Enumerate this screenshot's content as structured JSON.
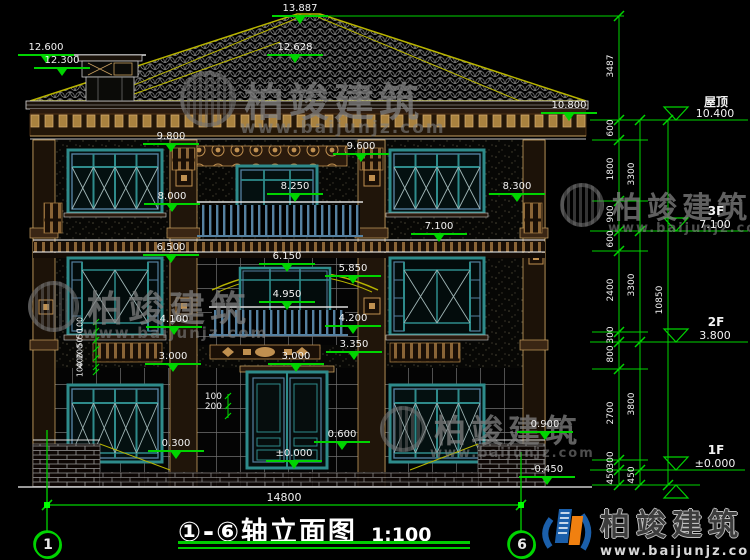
{
  "drawing": {
    "title": "①-⑥轴立面图",
    "scale": "1:100",
    "axis_left": "1",
    "axis_right": "6",
    "width_dim": "14800"
  },
  "elevation_markers": [
    {
      "label": "13.887",
      "x": 300,
      "y": 3
    },
    {
      "label": "12.600",
      "x": 46,
      "y": 42
    },
    {
      "label": "12.300",
      "x": 62,
      "y": 55
    },
    {
      "label": "12.628",
      "x": 295,
      "y": 42
    },
    {
      "label": "10.800",
      "x": 569,
      "y": 100
    },
    {
      "label": "9.800",
      "x": 171,
      "y": 131
    },
    {
      "label": "9.600",
      "x": 361,
      "y": 141
    },
    {
      "label": "8.250",
      "x": 295,
      "y": 181
    },
    {
      "label": "8.000",
      "x": 172,
      "y": 191
    },
    {
      "label": "8.300",
      "x": 517,
      "y": 181
    },
    {
      "label": "7.100",
      "x": 439,
      "y": 221
    },
    {
      "label": "6.500",
      "x": 171,
      "y": 242
    },
    {
      "label": "6.150",
      "x": 287,
      "y": 251
    },
    {
      "label": "5.850",
      "x": 353,
      "y": 263
    },
    {
      "label": "4.950",
      "x": 287,
      "y": 289
    },
    {
      "label": "4.200",
      "x": 353,
      "y": 313
    },
    {
      "label": "4.100",
      "x": 174,
      "y": 314
    },
    {
      "label": "3.350",
      "x": 354,
      "y": 339
    },
    {
      "label": "3.000",
      "x": 173,
      "y": 351
    },
    {
      "label": "3.000",
      "x": 296,
      "y": 351
    },
    {
      "label": "0.600",
      "x": 342,
      "y": 429
    },
    {
      "label": "±0.000",
      "x": 294,
      "y": 448
    },
    {
      "label": "0.900",
      "x": 545,
      "y": 419
    },
    {
      "label": "0.300",
      "x": 176,
      "y": 438
    },
    {
      "label": "-0.450",
      "x": 547,
      "y": 464
    }
  ],
  "right_panel": {
    "levels": [
      {
        "name": "屋顶",
        "value": "10.400",
        "y": 120
      },
      {
        "name": "3F",
        "value": "7.100",
        "y": 231
      },
      {
        "name": "2F",
        "value": "3.800",
        "y": 342
      },
      {
        "name": "1F",
        "value": "±0.000",
        "y": 470
      }
    ],
    "chain_inner": [
      {
        "label": "3487",
        "y": 68
      },
      {
        "label": "600",
        "y": 130
      },
      {
        "label": "1800",
        "y": 171
      },
      {
        "label": "900",
        "y": 216
      },
      {
        "label": "600",
        "y": 241
      },
      {
        "label": "2400",
        "y": 292
      },
      {
        "label": "300",
        "y": 337
      },
      {
        "label": "800",
        "y": 356
      },
      {
        "label": "2700",
        "y": 415
      },
      {
        "label": "300",
        "y": 462
      },
      {
        "label": "450",
        "y": 478
      }
    ],
    "chain_mid": [
      {
        "label": "3300",
        "y": 176
      },
      {
        "label": "3300",
        "y": 287
      },
      {
        "label": "3800",
        "y": 406
      },
      {
        "label": "450",
        "y": 477
      }
    ],
    "chain_outer": [
      {
        "label": "10850",
        "y": 302
      }
    ]
  },
  "detail_dims": {
    "left_stack": [
      {
        "label": "100",
        "y": 325
      },
      {
        "label": "50",
        "y": 334
      },
      {
        "label": "50",
        "y": 343
      },
      {
        "label": "200",
        "y": 352
      },
      {
        "label": "400",
        "y": 361
      },
      {
        "label": "100",
        "y": 370
      }
    ],
    "door_left": [
      {
        "label": "100",
        "y": 397
      },
      {
        "label": "200",
        "y": 407
      }
    ]
  },
  "watermarks": [
    {
      "brand": "柏竣建筑",
      "url": "www.baijunjz.com",
      "x": 180,
      "y": 70,
      "size": 40
    },
    {
      "brand": "柏竣建筑",
      "url": "www.baijunjz.com",
      "x": 28,
      "y": 280,
      "size": 36
    },
    {
      "brand": "柏竣建筑",
      "url": "www.baijunjz.com",
      "x": 560,
      "y": 183,
      "size": 30
    },
    {
      "brand": "柏竣建筑",
      "url": "www.baijunjz.com",
      "x": 380,
      "y": 406,
      "size": 32
    }
  ],
  "logo": {
    "brand": "柏竣建筑",
    "url": "www.baijunjz.com"
  },
  "colors": {
    "cad_green": "#00d400",
    "cad_yellow": "#b8b400",
    "window_teal": "#2e8b8b",
    "steel_blue": "#5580a0",
    "wood_brown": "#7a5230",
    "ornament_tan": "#c09050",
    "dim_text": "#f2f2f2"
  }
}
